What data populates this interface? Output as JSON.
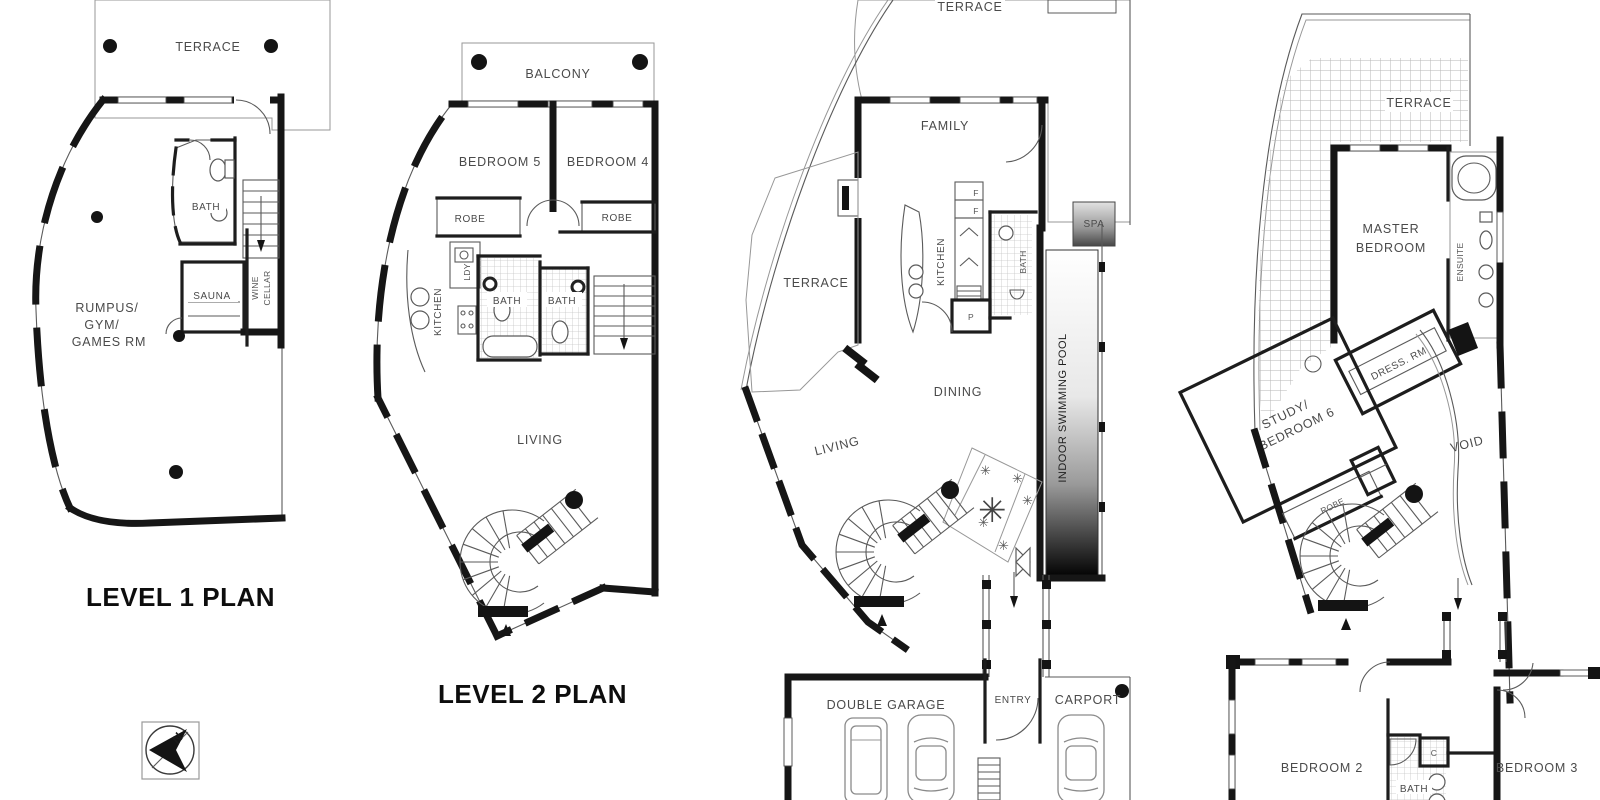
{
  "sheet": {
    "background": "#ffffff",
    "ink": "#161616",
    "label_color": "#4a4a4a"
  },
  "plans": {
    "level1": {
      "title": "LEVEL 1 PLAN",
      "labels": {
        "terrace": "TERRACE",
        "bath": "BATH",
        "sauna": "SAUNA",
        "rumpus_line1": "RUMPUS/",
        "rumpus_line2": "GYM/",
        "rumpus_line3": "GAMES RM",
        "wine_line1": "WINE",
        "wine_line2": "CELLAR"
      },
      "symbols": {
        "north": "N"
      }
    },
    "level2": {
      "title": "LEVEL 2 PLAN",
      "labels": {
        "balcony": "BALCONY",
        "bedroom5": "BEDROOM 5",
        "bedroom4": "BEDROOM 4",
        "robe_left": "ROBE",
        "robe_right": "ROBE",
        "laundry": "LDY",
        "kitchen": "KITCHEN",
        "bath_left": "BATH",
        "bath_right": "BATH",
        "living": "LIVING"
      }
    },
    "level3": {
      "labels": {
        "terrace_top": "TERRACE",
        "terrace_left": "TERRACE",
        "family": "FAMILY",
        "kitchen": "KITCHEN",
        "fridge_top": "F",
        "fridge_bottom": "F",
        "pantry": "P",
        "bath": "BATH",
        "spa": "SPA",
        "pool": "INDOOR SWIMMING POOL",
        "dining": "DINING",
        "living": "LIVING",
        "double_garage": "DOUBLE GARAGE",
        "entry": "ENTRY",
        "carport": "CARPORT"
      },
      "symbols": {
        "plant": "✳"
      }
    },
    "level4": {
      "labels": {
        "terrace": "TERRACE",
        "master_line1": "MASTER",
        "master_line2": "BEDROOM",
        "ensuite": "ENSUITE",
        "dress_room": "DRESS. RM",
        "study_line1": "STUDY/",
        "study_line2": "BEDROOM 6",
        "void_space": "VOID",
        "robe": "ROBE",
        "bedroom2": "BEDROOM 2",
        "bath": "BATH",
        "cupboard": "C",
        "bedroom3": "BEDROOM 3"
      }
    }
  }
}
